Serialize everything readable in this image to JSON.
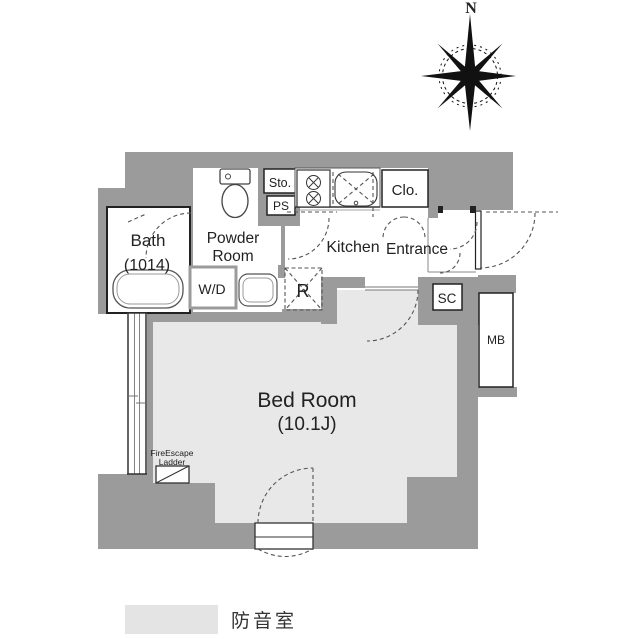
{
  "compass": {
    "north_label": "N"
  },
  "rooms": {
    "bath": {
      "name": "Bath",
      "size": "(1014)"
    },
    "powder": {
      "line1": "Powder",
      "line2": "Room"
    },
    "kitchen": {
      "name": "Kitchen"
    },
    "entrance": {
      "name": "Entrance"
    },
    "closet": {
      "name": "Clo."
    },
    "storage": {
      "name": "Sto."
    },
    "pipe_space": {
      "name": "PS"
    },
    "washer_dryer": {
      "name": "W/D"
    },
    "refrigerator": {
      "name": "R"
    },
    "shoe_closet": {
      "name": "SC"
    },
    "meter_box": {
      "name": "MB"
    },
    "bedroom": {
      "name": "Bed Room",
      "size": "(10.1J)"
    }
  },
  "annotations": {
    "fire_escape_line1": "FireEscape",
    "fire_escape_line2": "Ladder"
  },
  "legend": {
    "label": "防音室",
    "swatch_color": "#e4e4e4"
  },
  "colors": {
    "wall": "#9b9b9b",
    "floor": "#e8e8e8",
    "line": "#333333"
  }
}
